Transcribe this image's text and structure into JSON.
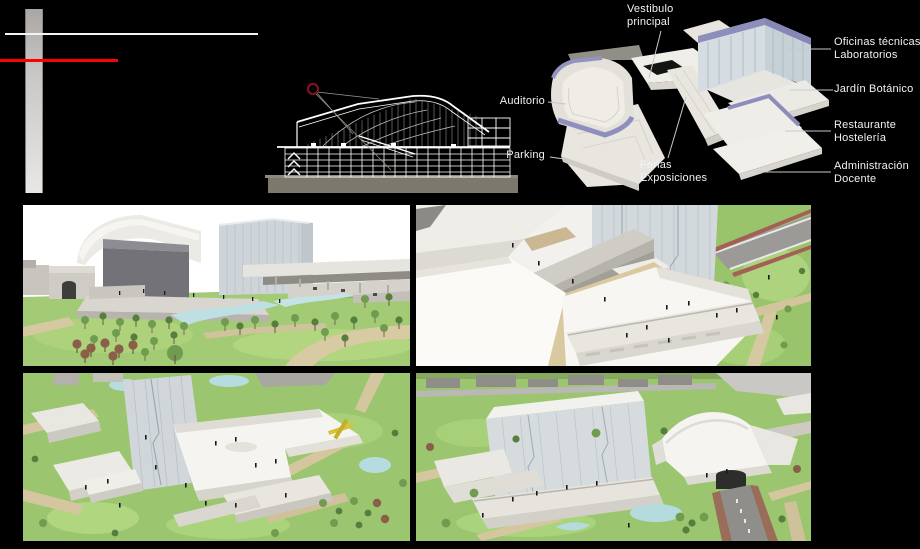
{
  "colors": {
    "background": "#000000",
    "accent_red": "#fe0000",
    "accent_purple": "#9191bf",
    "label_text": "#f2f2f2",
    "grass_green": "#9cc56f",
    "water_blue": "#b7dcdf"
  },
  "diagram_labels": {
    "vestibulo_principal": {
      "line1": "Vestibulo",
      "line2": "principal"
    },
    "auditorio": {
      "line1": "Auditorio"
    },
    "parking": {
      "line1": "Parking"
    },
    "ferias_exposiciones": {
      "line1": "Ferias",
      "line2": "Exposiciones"
    },
    "oficinas_laboratorios": {
      "line1": "Oficinas técnicas",
      "line2": "Laboratorios"
    },
    "jardin_botanico": {
      "line1": "Jardín Botánico"
    },
    "restaurante_hosteleria": {
      "line1": "Restaurante",
      "line2": "Hostelería"
    },
    "administracion_docente": {
      "line1": "Administración",
      "line2": "Docente"
    }
  }
}
